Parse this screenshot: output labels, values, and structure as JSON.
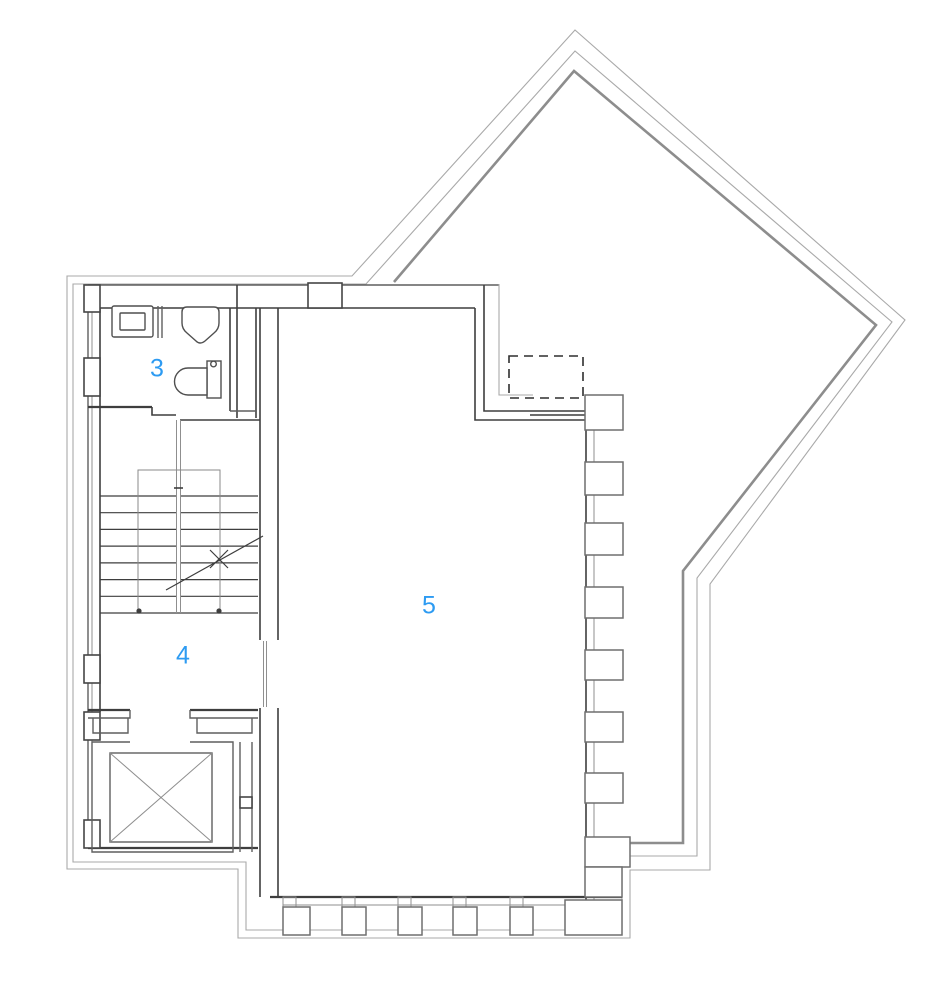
{
  "document": {
    "kind": "architectural floor plan",
    "background": "#ffffff"
  },
  "labels": {
    "room3": "3",
    "room4": "4",
    "room5": "5",
    "color": "#2d9bf2"
  },
  "symbols": [
    "terrace-boundary-outline",
    "terrace-parapet-line",
    "diamond-terrace",
    "skylight-dashed-outline",
    "staircase",
    "stair-direction-arrow",
    "elevator-shaft-cross",
    "toilet-icon",
    "sink-icon",
    "urinal-icon",
    "wall-columns",
    "door-leaves"
  ]
}
